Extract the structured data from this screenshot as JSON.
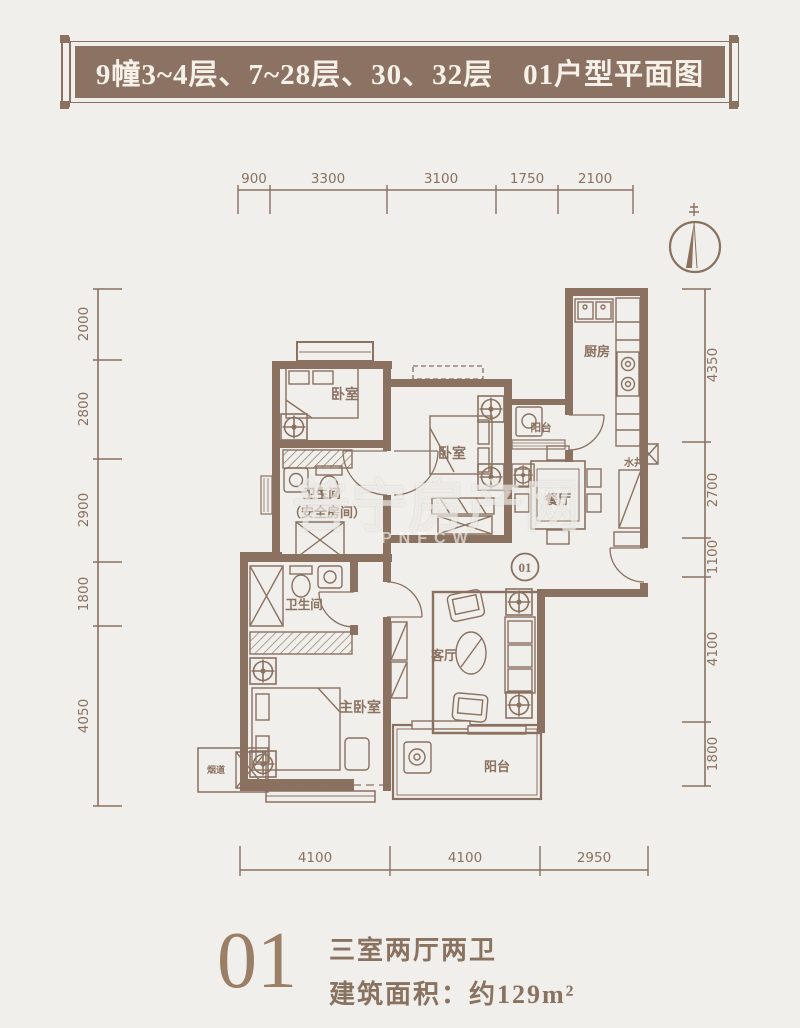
{
  "banner": {
    "title": "9幢3~4层、7~28层、30、32层　01户型平面图"
  },
  "dimensions": {
    "top": [
      "900",
      "3300",
      "3100",
      "1750",
      "2100"
    ],
    "bottom": [
      "4100",
      "4100",
      "2950"
    ],
    "left": [
      "2000",
      "2800",
      "2900",
      "1800",
      "4050"
    ],
    "right": [
      "4350",
      "2700",
      "1100",
      "4100",
      "1800"
    ]
  },
  "rooms": {
    "bedroom1": "卧室",
    "bedroom2": "卧室",
    "master_bedroom": "主卧室",
    "bathroom1": "卫生间",
    "bathroom1_note": "（安全房间）",
    "bathroom2": "卫生间",
    "kitchen": "厨房",
    "dining": "餐厅",
    "living": "客厅",
    "balcony": "阳台",
    "service_balcony": "阳台",
    "water_shaft": "水井",
    "flue": "烟道",
    "unit_number": "01"
  },
  "watermark": {
    "text": "普宁房产网",
    "subtext": "PNFCW"
  },
  "caption": {
    "unit": "01",
    "layout": "三室两厅两卫",
    "area": "建筑面积：约129m²"
  },
  "colors": {
    "line": "#8a7160",
    "banner_bg": "#8b7263",
    "banner_text": "#f6f1e8",
    "background": "#f0efeb"
  }
}
